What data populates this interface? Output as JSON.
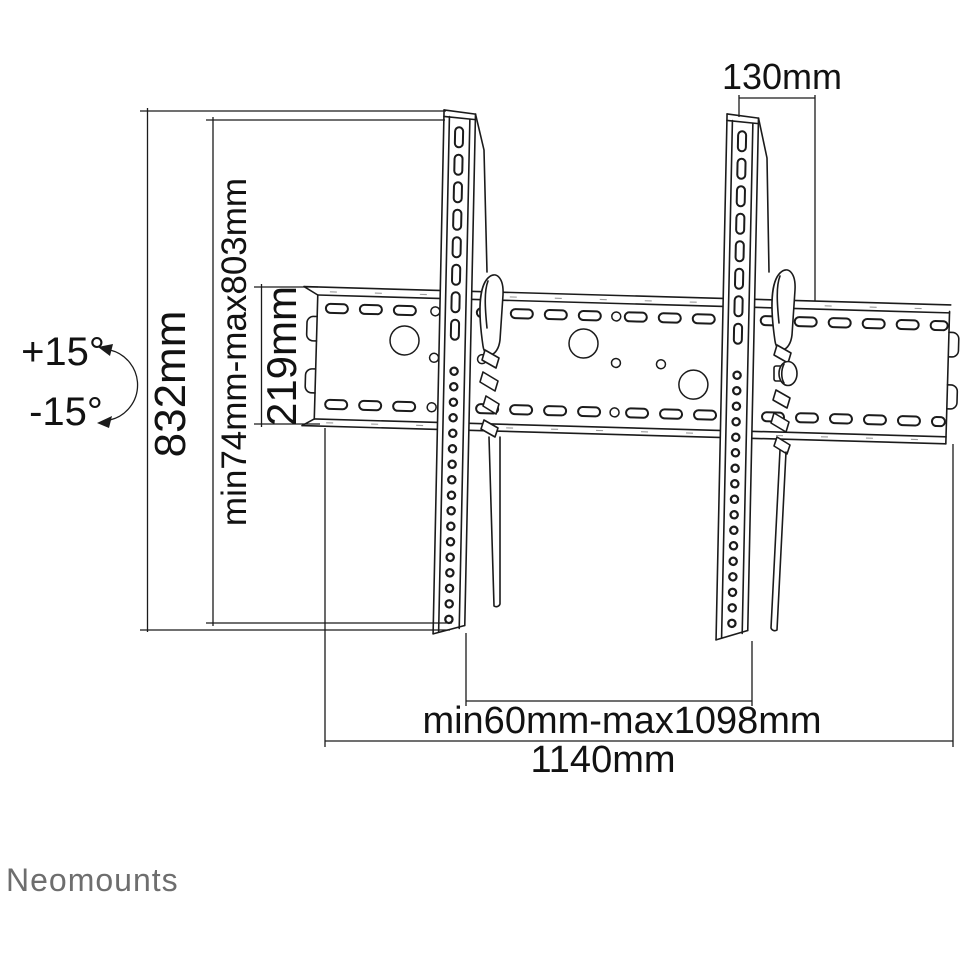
{
  "brand": {
    "logo": "Neomounts",
    "logo_color": "#6e6e6e"
  },
  "diagram": {
    "type": "tv-wall-mount-dimension-drawing",
    "line_color": "#1b1b1b",
    "background": "#ffffff",
    "dimensions": {
      "bracket_top_offset": "130mm",
      "bracket_height": "832mm",
      "height_adjust_range": "min74mm-max803mm",
      "wall_plate_height": "219mm",
      "tilt_up": "+15°",
      "tilt_down": "-15°",
      "bracket_width_range": "min60mm-max1098mm",
      "wall_plate_width": "1140mm"
    }
  }
}
